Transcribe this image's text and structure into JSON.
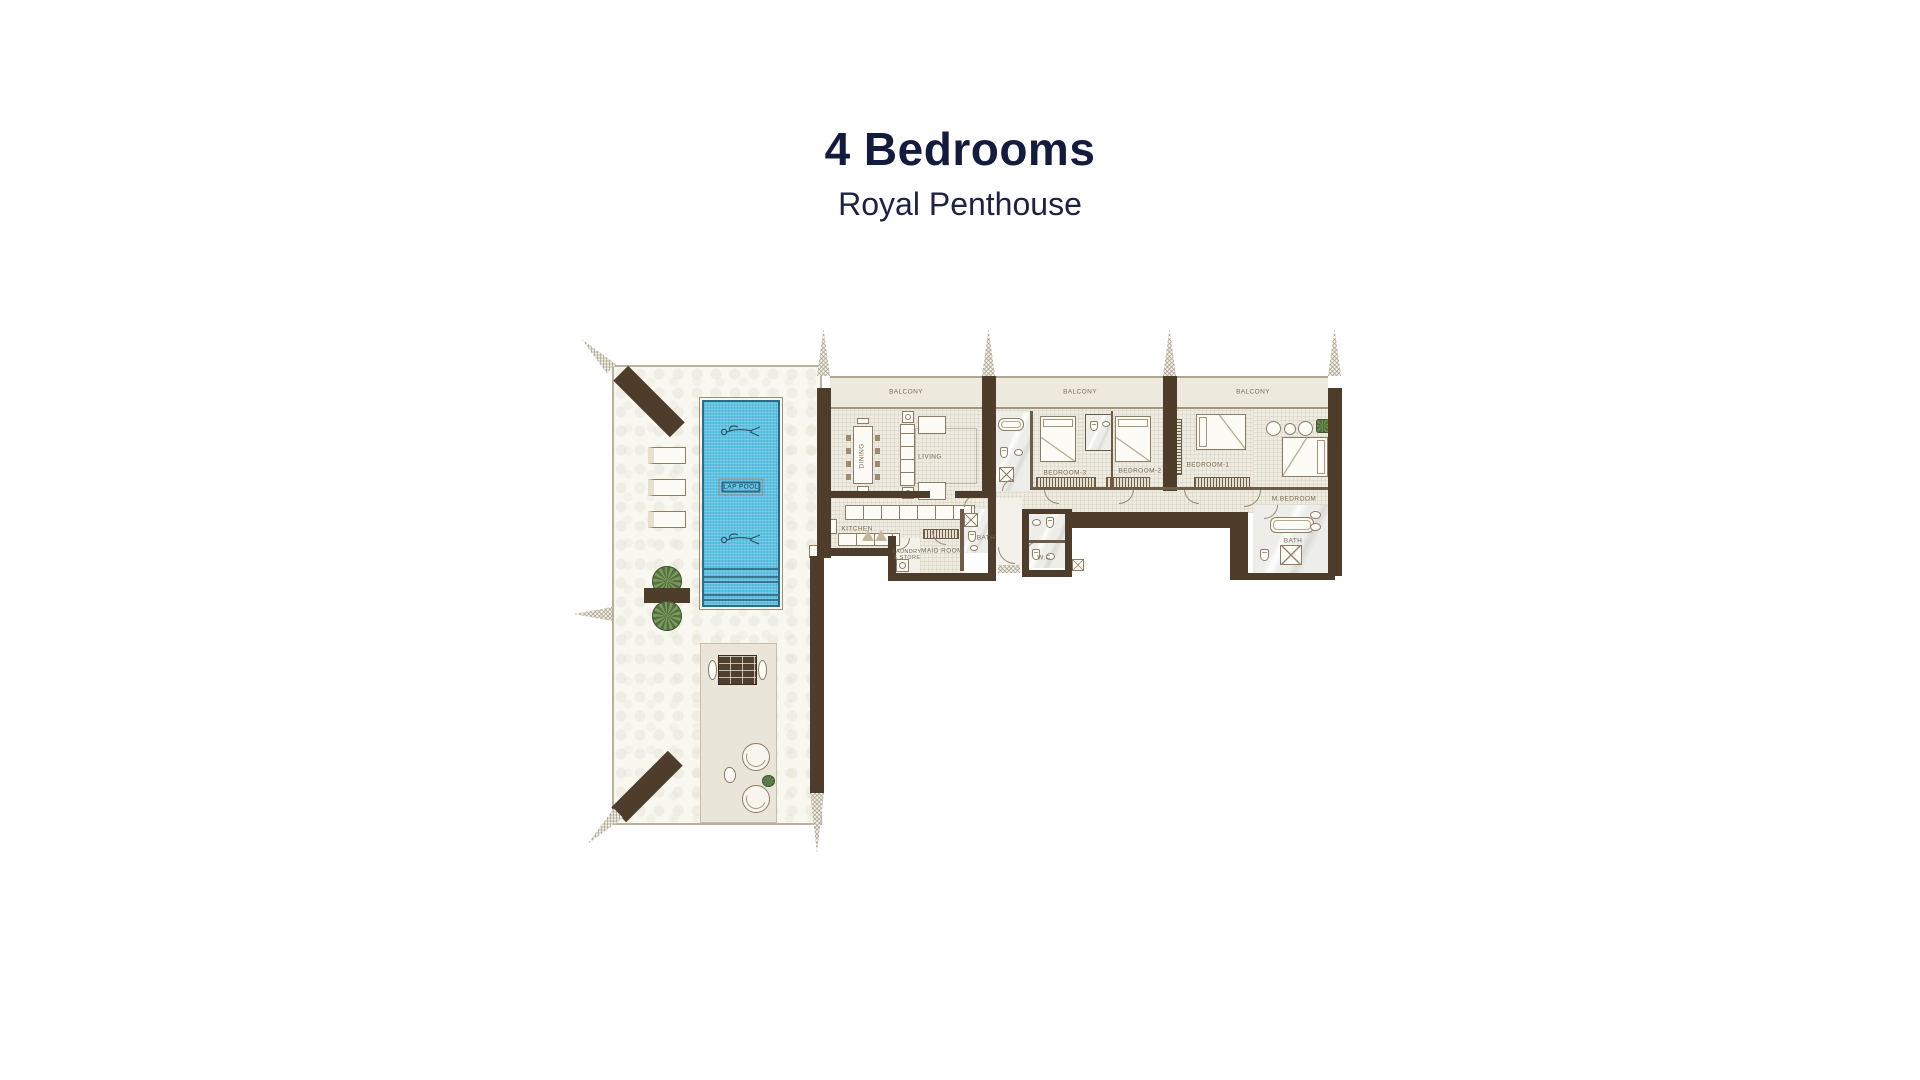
{
  "header": {
    "title": "4 Bedrooms",
    "subtitle": "Royal Penthouse"
  },
  "plan": {
    "rooms": {
      "balcony1": "BALCONY",
      "balcony2": "BALCONY",
      "balcony3": "BALCONY",
      "dining": "DINING",
      "living": "LIVING",
      "bedroom3": "BEDROOM-3",
      "bedroom2": "BEDROOM-2",
      "bedroom1": "BEDROOM-1",
      "master_bedroom": "M.BEDROOM",
      "kitchen": "KITCHEN",
      "laundry_store": "LAUNDRY & STORE",
      "maid_room": "MAID ROOM",
      "bath": "BATH",
      "wc": "W.C",
      "master_bath": "BATH",
      "lap_pool": "LAP POOL"
    },
    "colors": {
      "wall_brown": "#4e3d2b",
      "pool_blue": "#5fc3e3",
      "floor_tile": "#eeebe1",
      "balcony_floor": "#edeadd",
      "terrace": "#f8f7f0",
      "label_text": "#7a6c58",
      "title_navy": "#131b3e"
    },
    "icons": {
      "swimmer": "swimmer-icon",
      "plant": "plant-icon",
      "ac_unit": "ac-unit-icon"
    }
  }
}
